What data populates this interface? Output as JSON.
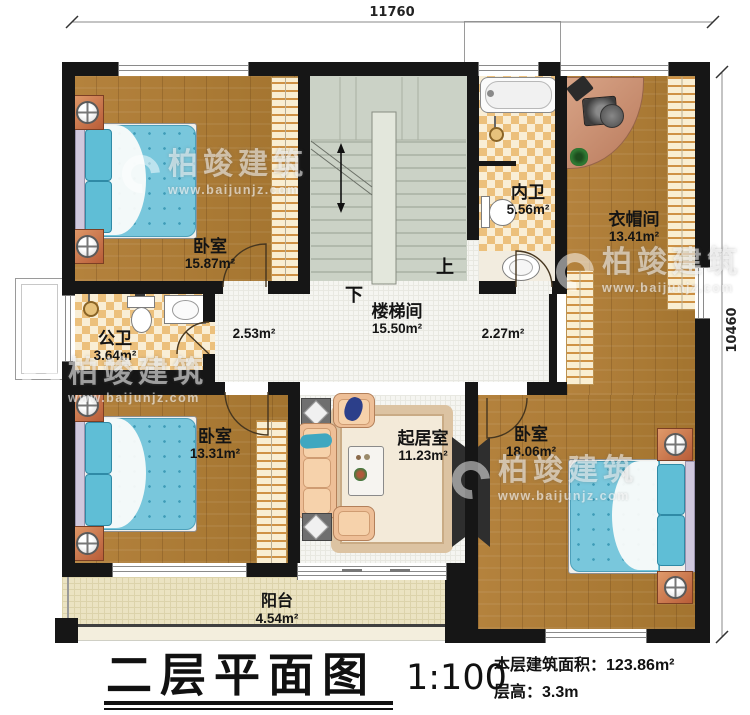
{
  "page": {
    "title": "二层平面图",
    "scale": "1:100",
    "area_label": "本层建筑面积：",
    "area_value": "123.86m²",
    "floor_height_label": "层高：",
    "floor_height_value": "3.3m"
  },
  "dimensions": {
    "top": "11760",
    "right": "10460"
  },
  "rooms": {
    "bedroom_tl": {
      "name": "卧室",
      "area": "15.87m²"
    },
    "bedroom_bl": {
      "name": "卧室",
      "area": "13.31m²"
    },
    "bedroom_br": {
      "name": "卧室",
      "area": "18.06m²"
    },
    "bath_public": {
      "name": "公卫",
      "area": "3.64m²"
    },
    "bath_inner": {
      "name": "内卫",
      "area": "5.56m²"
    },
    "cloakroom": {
      "name": "衣帽间",
      "area": "13.41m²"
    },
    "stairwell": {
      "name": "楼梯间",
      "area": "15.50m²"
    },
    "living": {
      "name": "起居室",
      "area": "11.23m²"
    },
    "balcony": {
      "name": "阳台",
      "area": "4.54m²"
    },
    "hall_left": {
      "area": "2.53m²"
    },
    "hall_right": {
      "area": "2.27m²"
    }
  },
  "stairs": {
    "up": "上",
    "down": "下"
  },
  "watermark": {
    "brand": "柏竣建筑",
    "url": "www.baijunjz.com"
  },
  "colors": {
    "wall": "#161616",
    "wood": "#ab7a38",
    "quilt": "#79c7dc",
    "checker": "#ecc07c",
    "stair_floor": "#cbd2c6",
    "balcony": "#ebe3c2",
    "closet": "#f9eed2",
    "copper": "#c97a52"
  }
}
